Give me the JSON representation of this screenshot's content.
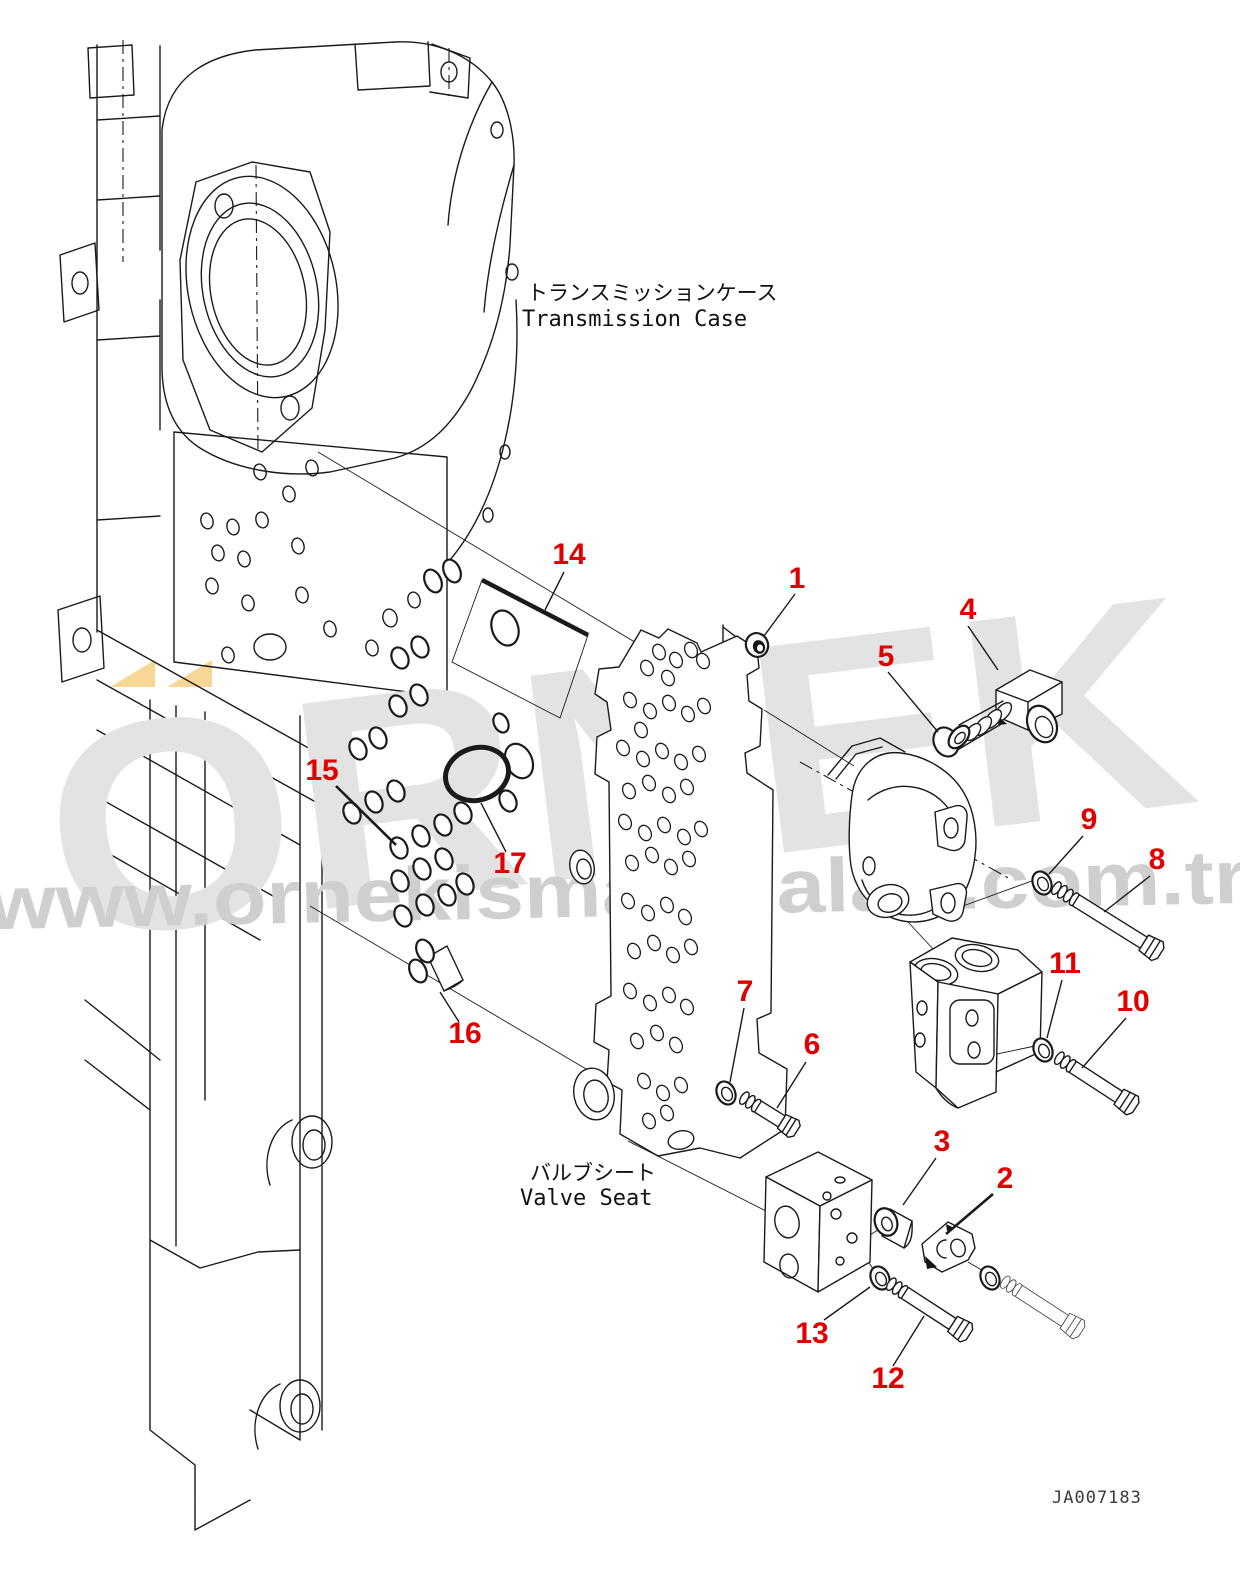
{
  "diagram": {
    "callouts": [
      "1",
      "2",
      "3",
      "4",
      "5",
      "6",
      "7",
      "8",
      "9",
      "10",
      "11",
      "12",
      "13",
      "14",
      "15",
      "16",
      "17"
    ]
  },
  "labels": {
    "transmission_case_ja": "トランスミッションケース",
    "transmission_case_en": "Transmission Case",
    "valve_seat_ja": "バルブシート",
    "valve_seat_en": "Valve Seat"
  },
  "doc": {
    "number": "JA007183"
  },
  "watermark": {
    "brand": "ORNEK",
    "url": "www.ornekismakinalari.com.tr",
    "text_color": "#e3e3e3",
    "url_color": "#cfcfcf",
    "accent_color": "#f6d795"
  },
  "colors": {
    "callout_red": "#e10000",
    "line": "#1a1a1a",
    "background": "#ffffff"
  }
}
